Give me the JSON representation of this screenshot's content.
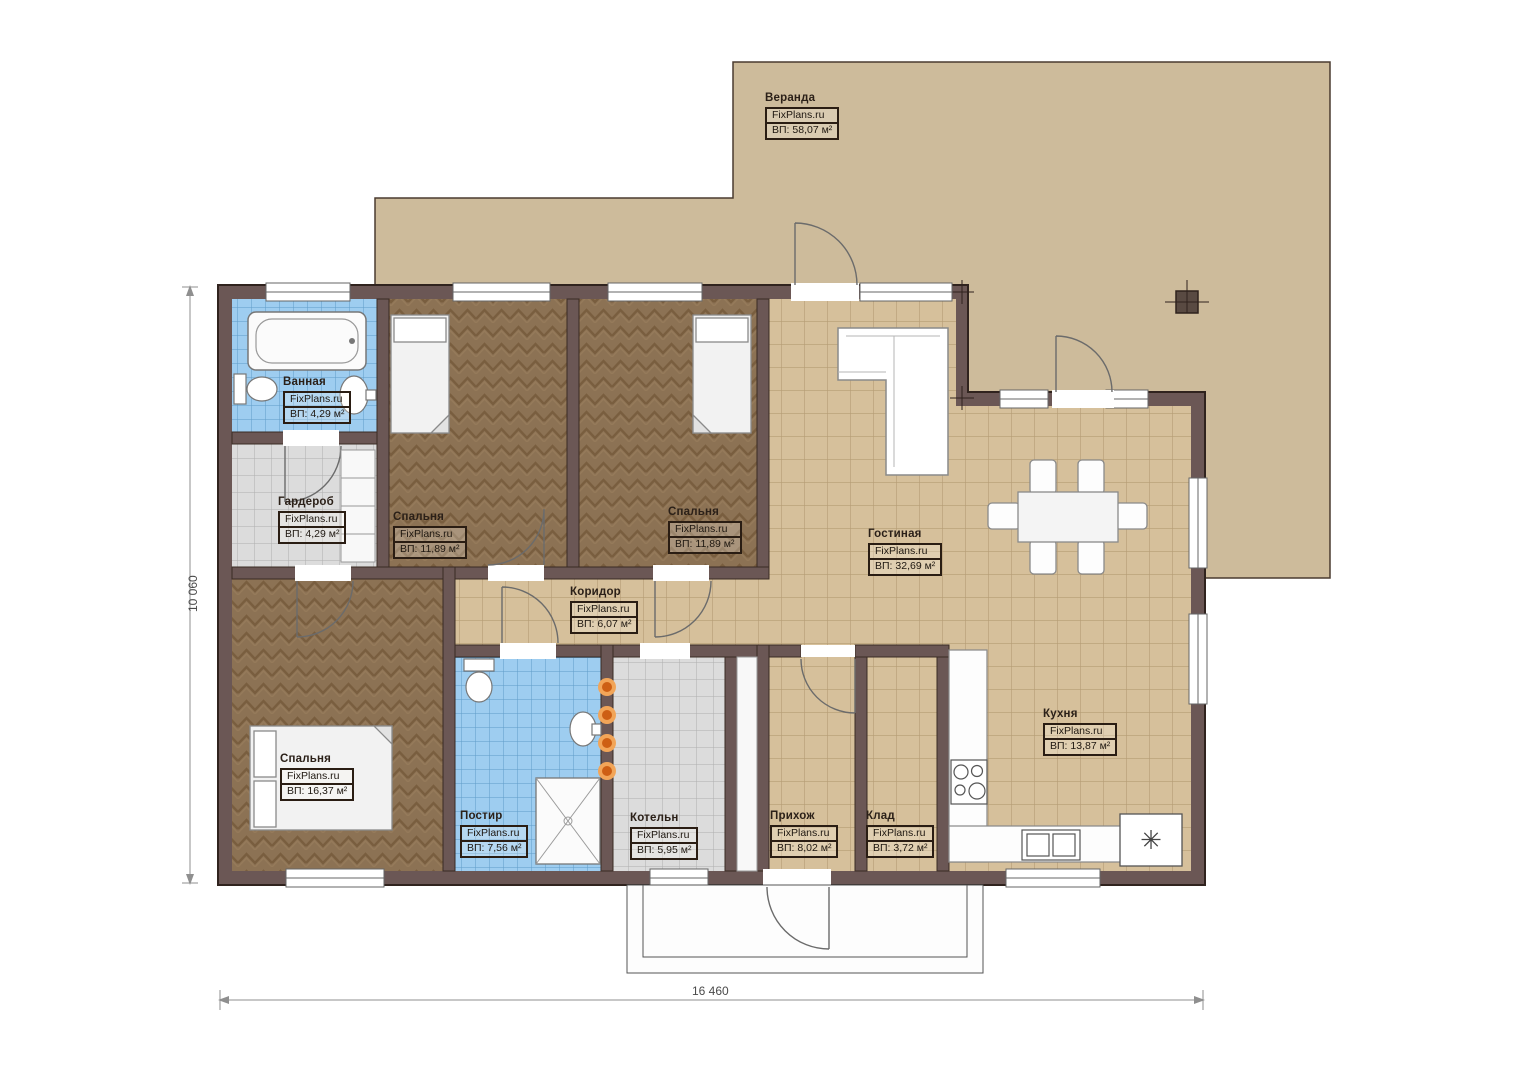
{
  "plan": {
    "brand": "FixPlans.ru",
    "rooms": [
      {
        "id": "veranda",
        "name": "Веранда",
        "area": "ВП: 58,07 м²"
      },
      {
        "id": "vannaya",
        "name": "Ванная",
        "area": "ВП: 4,29 м²"
      },
      {
        "id": "garderob",
        "name": "Гардероб",
        "area": "ВП: 4,29 м²"
      },
      {
        "id": "spalnya1",
        "name": "Спальня",
        "area": "ВП: 11,89 м²"
      },
      {
        "id": "spalnya2",
        "name": "Спальня",
        "area": "ВП: 11,89 м²"
      },
      {
        "id": "gostinaya",
        "name": "Гостиная",
        "area": "ВП: 32,69 м²"
      },
      {
        "id": "koridor",
        "name": "Коридор",
        "area": "ВП: 6,07 м²"
      },
      {
        "id": "spalnya3",
        "name": "Спальня",
        "area": "ВП: 16,37 м²"
      },
      {
        "id": "postir",
        "name": "Постир",
        "area": "ВП: 7,56 м²"
      },
      {
        "id": "kotelnaya",
        "name": "Котельн",
        "area": "ВП: 5,95 м²"
      },
      {
        "id": "prihozh",
        "name": "Прихож",
        "area": "ВП: 8,02 м²"
      },
      {
        "id": "klad",
        "name": "Клад",
        "area": "ВП: 3,72 м²"
      },
      {
        "id": "kuhnya",
        "name": "Кухня",
        "area": "ВП: 13,87 м²"
      }
    ],
    "dimensions": {
      "width": "16 460",
      "height": "10 060"
    },
    "icons": {
      "freezer_glyph": "✳"
    },
    "colors": {
      "wall": "#6b5755",
      "veranda_floor": "#cdbb9b",
      "tile_tan": "#d6c09b",
      "tile_blue": "#9ecdf0",
      "tile_gray": "#dcdcdc",
      "wood": "#8c7254",
      "accent_orange": "#e8832c"
    }
  }
}
